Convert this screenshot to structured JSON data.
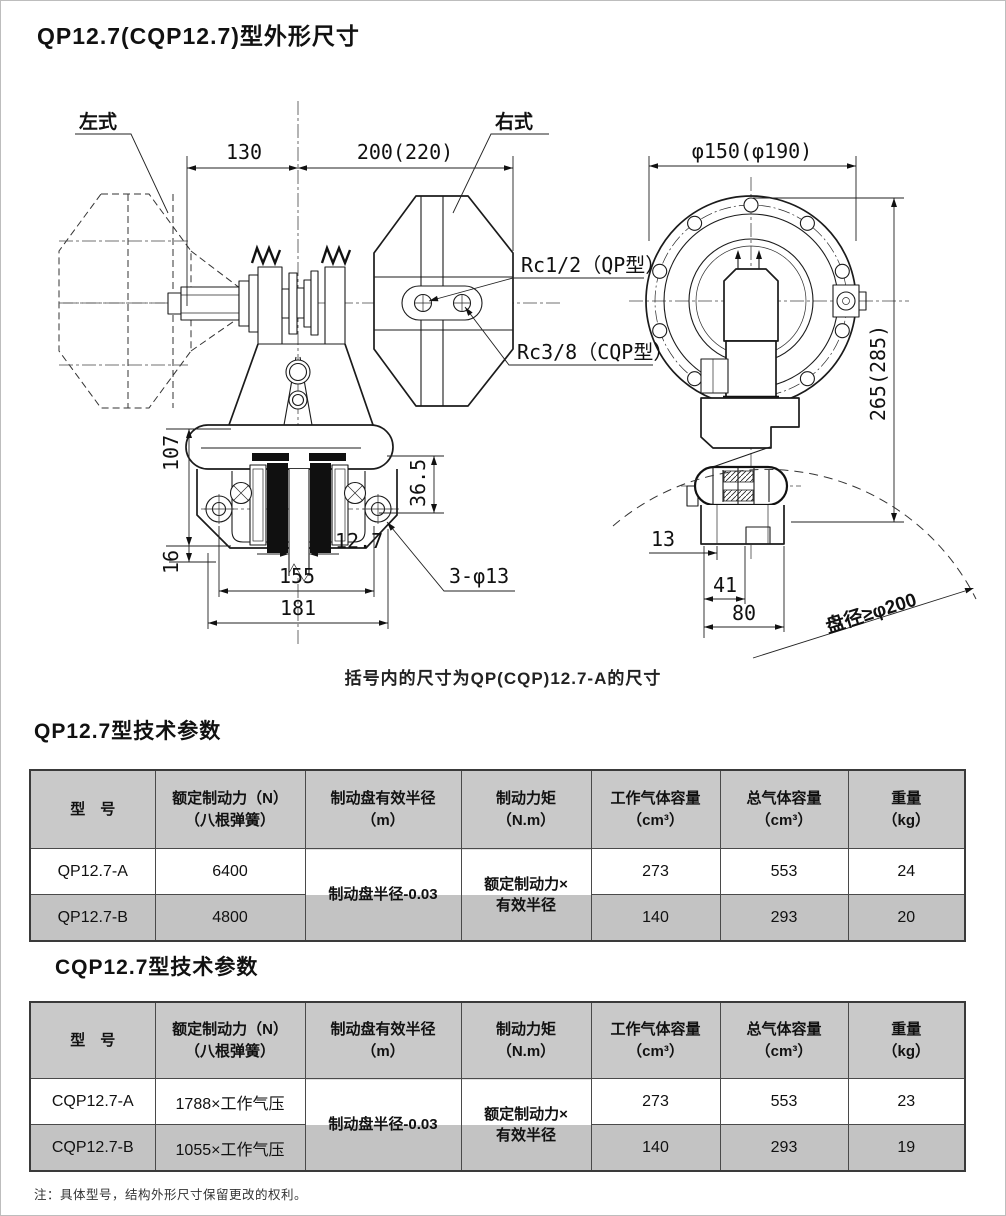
{
  "page": {
    "title": "QP12.7(CQP12.7)型外形尺寸",
    "caption": "括号内的尺寸为QP(CQP)12.7-A的尺寸",
    "footnote": "注：具体型号，结构外形尺寸保留更改的权利。"
  },
  "drawing": {
    "labels": {
      "left_type": "左式",
      "right_type": "右式",
      "rc_qp": "Rc1/2（QP型）",
      "rc_cqp": "Rc3/8（CQP型）",
      "disc_note": "盘径≥φ200"
    },
    "dims": {
      "d130": "130",
      "d200": "200(220)",
      "flange": "φ150(φ190)",
      "d265": "265(285)",
      "d107": "107",
      "d36_5": "36.5",
      "d16": "16",
      "d12_7": "12.7",
      "d155": "155",
      "d181": "181",
      "holes": "3-φ13",
      "d13": "13",
      "d41": "41",
      "d80": "80"
    }
  },
  "table_qp": {
    "title": "QP12.7型技术参数",
    "headers": [
      {
        "l1": "型　号",
        "l2": ""
      },
      {
        "l1": "额定制动力（N）",
        "l2": "（八根弹簧）"
      },
      {
        "l1": "制动盘有效半径",
        "l2": "（m）"
      },
      {
        "l1": "制动力矩",
        "l2": "（N.m）"
      },
      {
        "l1": "工作气体容量",
        "l2": "（cm³）"
      },
      {
        "l1": "总气体容量",
        "l2": "（cm³）"
      },
      {
        "l1": "重量",
        "l2": "（kg）"
      }
    ],
    "merged": {
      "radius": "制动盘半径-0.03",
      "torque_l1": "额定制动力×",
      "torque_l2": "有效半径"
    },
    "rows": [
      {
        "model": "QP12.7-A",
        "force": "6400",
        "work_vol": "273",
        "total_vol": "553",
        "weight": "24"
      },
      {
        "model": "QP12.7-B",
        "force": "4800",
        "work_vol": "140",
        "total_vol": "293",
        "weight": "20"
      }
    ]
  },
  "table_cqp": {
    "title": "CQP12.7型技术参数",
    "headers": [
      {
        "l1": "型　号",
        "l2": ""
      },
      {
        "l1": "额定制动力（N）",
        "l2": "（八根弹簧）"
      },
      {
        "l1": "制动盘有效半径",
        "l2": "（m）"
      },
      {
        "l1": "制动力矩",
        "l2": "（N.m）"
      },
      {
        "l1": "工作气体容量",
        "l2": "（cm³）"
      },
      {
        "l1": "总气体容量",
        "l2": "（cm³）"
      },
      {
        "l1": "重量",
        "l2": "（kg）"
      }
    ],
    "merged": {
      "radius": "制动盘半径-0.03",
      "torque_l1": "额定制动力×",
      "torque_l2": "有效半径"
    },
    "rows": [
      {
        "model": "CQP12.7-A",
        "force": "1788×工作气压",
        "work_vol": "273",
        "total_vol": "553",
        "weight": "23"
      },
      {
        "model": "CQP12.7-B",
        "force": "1055×工作气压",
        "work_vol": "140",
        "total_vol": "293",
        "weight": "19"
      }
    ]
  }
}
